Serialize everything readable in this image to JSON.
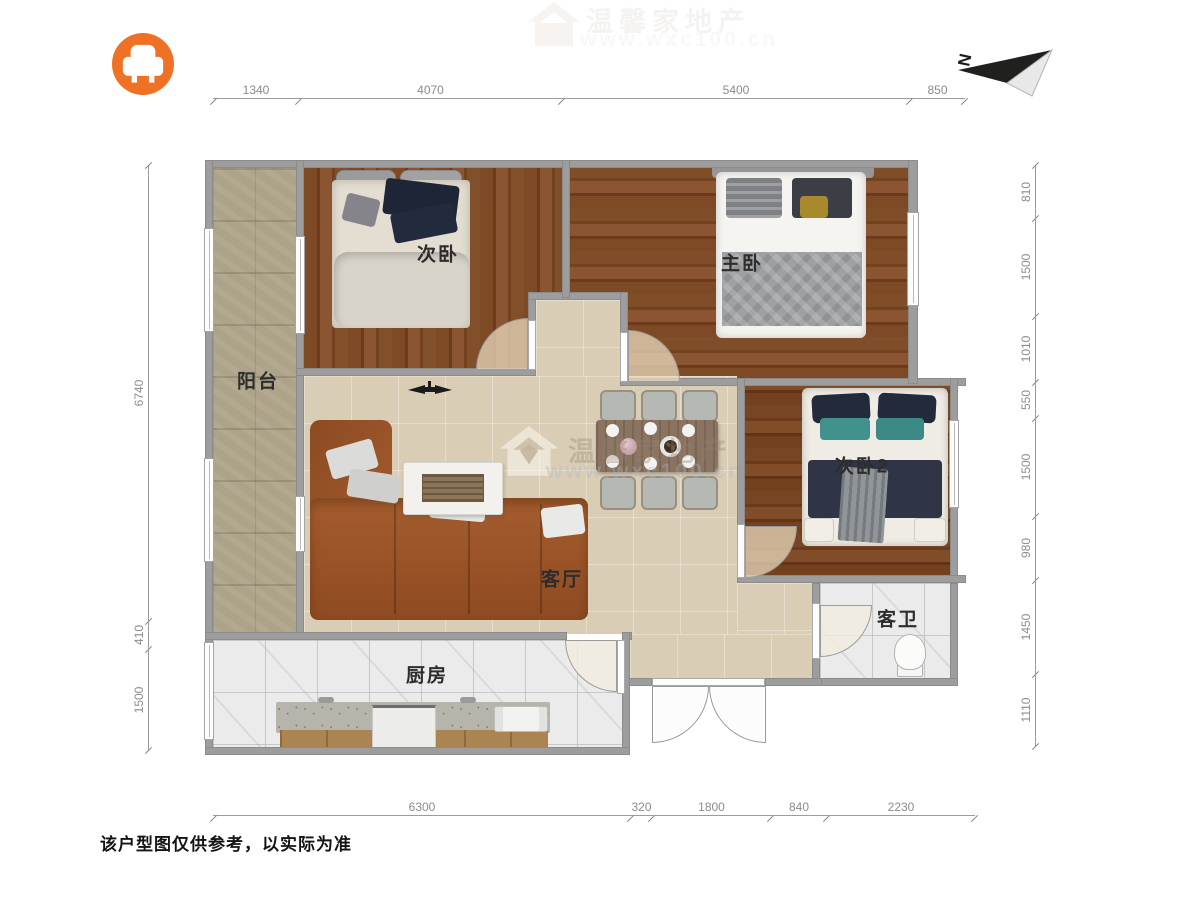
{
  "logo": {
    "icon": "armchair-icon",
    "color": "#ee7125"
  },
  "compass": {
    "label": "N"
  },
  "rooms": {
    "balcony": "阳台",
    "bedroom1": "次卧",
    "master": "主卧",
    "bedroom2": "次卧2",
    "living": "客厅",
    "bathroom": "客卫",
    "kitchen": "厨房"
  },
  "dimensions": {
    "top": [
      "1340",
      "4070",
      "5400",
      "850"
    ],
    "right": [
      "810",
      "1500",
      "1010",
      "550",
      "1500",
      "980",
      "1450",
      "1110"
    ],
    "left": [
      "6740",
      "410",
      "1500"
    ],
    "bottom": [
      "6300",
      "320",
      "1800",
      "840",
      "2230"
    ]
  },
  "watermark": {
    "brand": "温馨家地产",
    "url": "www.wxc100.cn",
    "icon": "house-icon"
  },
  "disclaimer": "该户型图仅供参考，以实际为准",
  "colors": {
    "accent_orange": "#ee7125",
    "wall_gray": "#9d9d9d",
    "wood_floor": "#7d4a25",
    "tile_beige": "#d9cdb5",
    "marble_white": "#ebebec"
  }
}
